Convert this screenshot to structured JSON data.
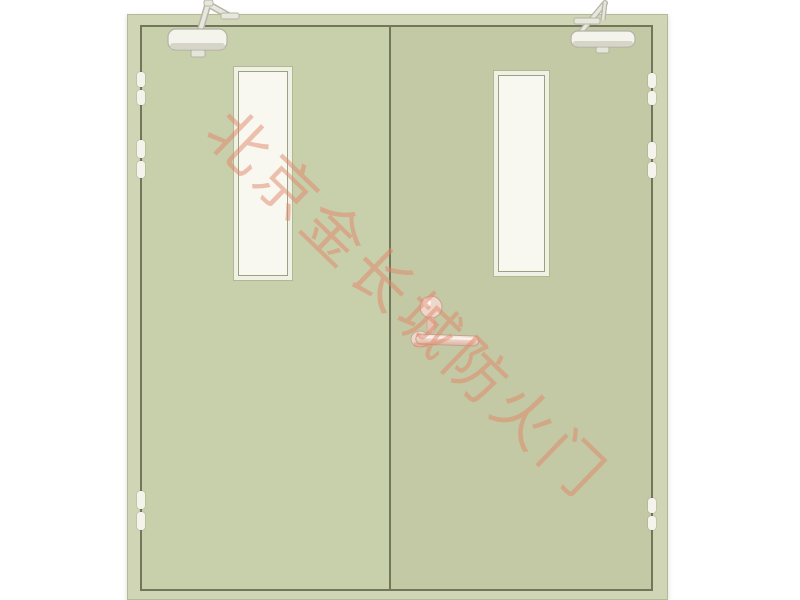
{
  "watermark": {
    "text": "北京金长城防火门",
    "color": "#e2876a"
  },
  "colors": {
    "background": "#ffffff",
    "frame": "#d0d5b6",
    "left_leaf": "#c8cfab",
    "right_leaf": "#c2c9a4",
    "gap_line": "#72765a",
    "glass": "#f8f8f1",
    "panel_trim": "#f0f1e5",
    "hardware": "#f4f3ec",
    "hardware_shade": "#d6d5c8",
    "handle": "#ecd2c4",
    "handle_edge": "#c7a28e"
  }
}
